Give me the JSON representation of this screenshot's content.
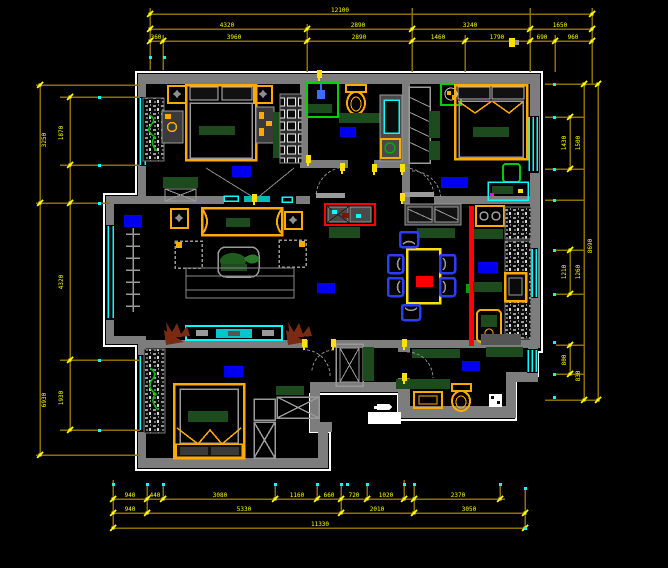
{
  "drawing": {
    "type": "cad-floor-plan",
    "background": "#000000",
    "colors": {
      "wall": "#7d7d7d",
      "outline": "#ffffff",
      "window": "#00ffff",
      "dim_line": "#8a7000",
      "dim_tick": "#ffff00",
      "dim_text": "#ffff00",
      "furniture_accent": "#ffaa00",
      "bedding_green": "#1e4b1e",
      "door_symbol_green": "#00d200",
      "chair_blue": "#2b3cff",
      "room_label_blue": "#0000ee",
      "highlight_wall_red": "#ff0000",
      "plant_brown": "#7a2a12",
      "defpoint_cyan": "#00ffff"
    },
    "blocks": [
      "double-bed",
      "wardrobe-hatched",
      "closet-shelved",
      "sliding-door",
      "nightstand",
      "dressing-table",
      "bench",
      "sofa-set",
      "coffee-table",
      "area-rug",
      "tv-cabinet",
      "plant",
      "radiator",
      "dining-table",
      "dining-chair",
      "sideboard",
      "shoe-cabinet",
      "gas-stove",
      "kitchen-sink",
      "kitchen-counter",
      "water-heater",
      "toilet",
      "shower",
      "washing-machine",
      "bathroom-vanity",
      "floor-drain",
      "door-arc",
      "window-triple-line",
      "room-label-block"
    ],
    "rooms": [
      {
        "name": "bedroom-top-left"
      },
      {
        "name": "bathroom-top"
      },
      {
        "name": "bedroom-top-right"
      },
      {
        "name": "living-room"
      },
      {
        "name": "dining-room"
      },
      {
        "name": "kitchen"
      },
      {
        "name": "bedroom-bottom-left"
      },
      {
        "name": "bathroom-bottom"
      },
      {
        "name": "hallway"
      }
    ],
    "dims": {
      "top1": [
        "12100"
      ],
      "top2": [
        "4320",
        "2890",
        "3240",
        "1650"
      ],
      "top3": [
        "360",
        "3960",
        "2890",
        "1460",
        "1790",
        "690",
        "960"
      ],
      "bot1": [
        "940",
        "440",
        "3080",
        "1160",
        "660",
        "720",
        "1020",
        "2370"
      ],
      "bot2": [
        "940",
        "5330",
        "2010",
        "3050"
      ],
      "bot3": [
        "11330"
      ],
      "left_out": [
        "3250",
        "6930"
      ],
      "left_in": [
        "1870",
        "4320",
        "1930"
      ],
      "right_a": [
        "1430",
        "1210",
        "800"
      ],
      "right_b": [
        "1500",
        "1260",
        "830"
      ],
      "right_out": [
        "8690"
      ]
    }
  }
}
